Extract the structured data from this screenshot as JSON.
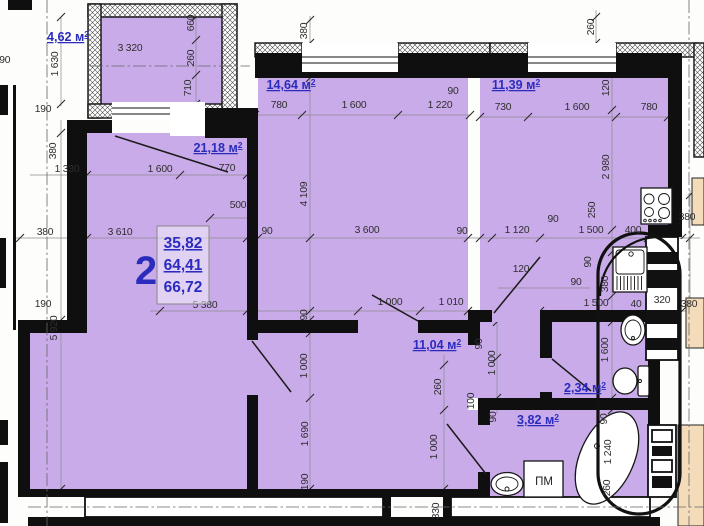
{
  "plan": {
    "stamp": {
      "flat_number": "2",
      "values": [
        "35,82",
        "64,41",
        "66,72"
      ]
    },
    "rooms": [
      {
        "name": "balcony",
        "area": "4,62",
        "x": 68,
        "y": 41
      },
      {
        "name": "bedroom",
        "area": "14,64",
        "x": 291,
        "y": 89
      },
      {
        "name": "kitchen",
        "area": "11,39",
        "x": 516,
        "y": 89
      },
      {
        "name": "living",
        "area": "21,18",
        "x": 218,
        "y": 152
      },
      {
        "name": "hall",
        "area": "11,04",
        "x": 437,
        "y": 349
      },
      {
        "name": "wc",
        "area": "2,34",
        "x": 585,
        "y": 392
      },
      {
        "name": "bath",
        "area": "3,82",
        "x": 538,
        "y": 424
      }
    ],
    "washing_machine_label": "ПМ",
    "area_unit": "м",
    "area_sup": "2",
    "dim_labels": [
      {
        "t": "3 320",
        "x": 130,
        "y": 51
      },
      {
        "t": "1 630",
        "x": 58,
        "y": 64,
        "r": 1
      },
      {
        "t": "660",
        "x": 194,
        "y": 23,
        "r": 1
      },
      {
        "t": "260",
        "x": 194,
        "y": 58,
        "r": 1
      },
      {
        "t": "710",
        "x": 191,
        "y": 88,
        "r": 1
      },
      {
        "t": "190",
        "x": 43,
        "y": 112
      },
      {
        "t": "190",
        "x": 2,
        "y": 63
      },
      {
        "t": "380",
        "x": 307,
        "y": 31,
        "r": 1
      },
      {
        "t": "780",
        "x": 279,
        "y": 108
      },
      {
        "t": "1 600",
        "x": 354,
        "y": 108
      },
      {
        "t": "1 220",
        "x": 440,
        "y": 108
      },
      {
        "t": "90",
        "x": 453,
        "y": 94
      },
      {
        "t": "730",
        "x": 503,
        "y": 110
      },
      {
        "t": "1 600",
        "x": 577,
        "y": 110
      },
      {
        "t": "780",
        "x": 649,
        "y": 110
      },
      {
        "t": "260",
        "x": 594,
        "y": 27,
        "r": 1
      },
      {
        "t": "120",
        "x": 609,
        "y": 88,
        "r": 1
      },
      {
        "t": "2 980",
        "x": 609,
        "y": 167,
        "r": 1
      },
      {
        "t": "1 330",
        "x": 67,
        "y": 172
      },
      {
        "t": "1 600",
        "x": 160,
        "y": 172
      },
      {
        "t": "770",
        "x": 227,
        "y": 171
      },
      {
        "t": "500",
        "x": 238,
        "y": 208
      },
      {
        "t": "380",
        "x": 45,
        "y": 235
      },
      {
        "t": "3 610",
        "x": 120,
        "y": 235
      },
      {
        "t": "90",
        "x": 267,
        "y": 234
      },
      {
        "t": "3 600",
        "x": 367,
        "y": 233
      },
      {
        "t": "90",
        "x": 462,
        "y": 234
      },
      {
        "t": "1 120",
        "x": 517,
        "y": 233
      },
      {
        "t": "1 500",
        "x": 591,
        "y": 233
      },
      {
        "t": "400",
        "x": 633,
        "y": 233
      },
      {
        "t": "250",
        "x": 595,
        "y": 210,
        "r": 1
      },
      {
        "t": "90",
        "x": 553,
        "y": 222
      },
      {
        "t": "380",
        "x": 687,
        "y": 220
      },
      {
        "t": "4 109",
        "x": 307,
        "y": 194,
        "r": 1
      },
      {
        "t": "380",
        "x": 56,
        "y": 151,
        "r": 1
      },
      {
        "t": "120",
        "x": 521,
        "y": 272
      },
      {
        "t": "90",
        "x": 591,
        "y": 262,
        "r": 1
      },
      {
        "t": "380",
        "x": 608,
        "y": 284,
        "r": 1
      },
      {
        "t": "90",
        "x": 576,
        "y": 285
      },
      {
        "t": "90",
        "x": 307,
        "y": 315,
        "r": 1
      },
      {
        "t": "5 380",
        "x": 205,
        "y": 308
      },
      {
        "t": "1 000",
        "x": 390,
        "y": 305
      },
      {
        "t": "1 010",
        "x": 451,
        "y": 305
      },
      {
        "t": "1 500",
        "x": 596,
        "y": 306
      },
      {
        "t": "40",
        "x": 636,
        "y": 307
      },
      {
        "t": "320",
        "x": 662,
        "y": 303
      },
      {
        "t": "380",
        "x": 689,
        "y": 307
      },
      {
        "t": "5 920",
        "x": 57,
        "y": 328,
        "r": 1
      },
      {
        "t": "190",
        "x": 43,
        "y": 307
      },
      {
        "t": "90",
        "x": 482,
        "y": 344,
        "r": 1
      },
      {
        "t": "1 000",
        "x": 495,
        "y": 363,
        "r": 1
      },
      {
        "t": "100",
        "x": 474,
        "y": 401,
        "r": 1
      },
      {
        "t": "1 600",
        "x": 608,
        "y": 350,
        "r": 1
      },
      {
        "t": "1 000",
        "x": 307,
        "y": 366,
        "r": 1
      },
      {
        "t": "260",
        "x": 441,
        "y": 387,
        "r": 1
      },
      {
        "t": "1 690",
        "x": 308,
        "y": 434,
        "r": 1
      },
      {
        "t": "190",
        "x": 308,
        "y": 482,
        "r": 1
      },
      {
        "t": "1 000",
        "x": 437,
        "y": 447,
        "r": 1
      },
      {
        "t": "330",
        "x": 439,
        "y": 511,
        "r": 1
      },
      {
        "t": "90",
        "x": 496,
        "y": 417,
        "r": 1
      },
      {
        "t": "90",
        "x": 607,
        "y": 419,
        "r": 1
      },
      {
        "t": "1 240",
        "x": 611,
        "y": 452,
        "r": 1
      },
      {
        "t": "260",
        "x": 610,
        "y": 488,
        "r": 1
      }
    ],
    "colors": {
      "room_fill": "#c9abe9",
      "wall": "#0f0f0f",
      "accent": "#2b2cbe",
      "dim_text": "#2e2e2e",
      "adjacent": "#f4dcba"
    }
  }
}
